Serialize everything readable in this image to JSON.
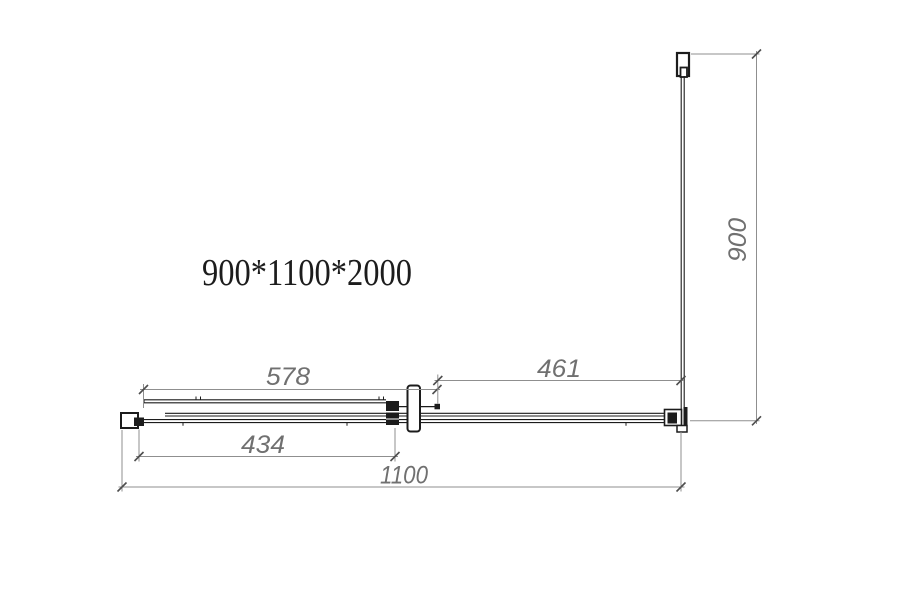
{
  "drawing": {
    "title": "900*1100*2000",
    "dimensions": {
      "front_track_width": "578",
      "fixed_panel_width": "461",
      "door_opening_width": "434",
      "total_front_width": "1100",
      "side_panel_depth": "900"
    },
    "colors": {
      "drawing_line": "#1c1c1c",
      "dimension_line": "#8f8f8f",
      "dimension_text": "#707070",
      "background": "#ffffff"
    }
  }
}
